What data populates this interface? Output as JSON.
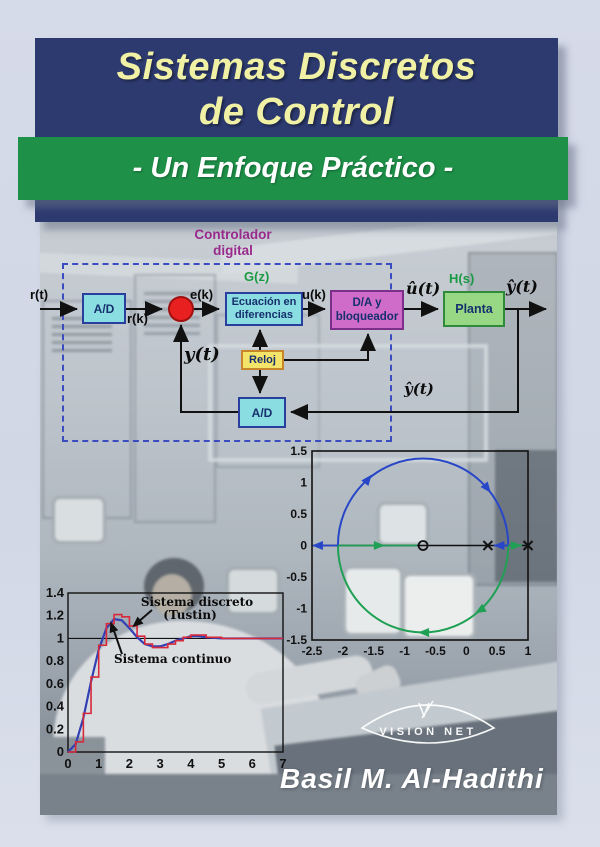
{
  "cover": {
    "title_line1": "Sistemas Discretos",
    "title_line2": "de Control",
    "subtitle": "- Un Enfoque Práctico -",
    "author": "Basil M. Al-Hadithi",
    "publisher": "VISION NET"
  },
  "colors": {
    "background": "#d3d9e7",
    "banner_navy": "#2d3a70",
    "banner_green": "#1e9048",
    "title_yellow": "#f0f1a4",
    "block_cyan": "#8adde0",
    "block_magenta": "#cf6cc9",
    "block_green": "#98d884",
    "block_yellow": "#f5e46a",
    "sum_red": "#e82020",
    "dashed_border_blue": "#3a4cc0",
    "controller_label_purple": "#992a8c",
    "transfer_label_green": "#1a9a44",
    "locus_blue": "#2847c8",
    "locus_green": "#1fa055",
    "curve_blue": "#3340b4",
    "curve_red": "#d8293a"
  },
  "diagram": {
    "controller_label_line1": "Controlador",
    "controller_label_line2": "digital",
    "gz_label": "G(z)",
    "hs_label": "H(s)",
    "blocks": {
      "ad_input": "A/D",
      "difference_eq_line1": "Ecuación en",
      "difference_eq_line2": "diferencias",
      "da_hold_line1": "D/A y",
      "da_hold_line2": "bloqueador",
      "plant": "Planta",
      "clock": "Reloj",
      "ad_feedback": "A/D"
    },
    "signals": {
      "r_t": "r(t)",
      "r_k": "r(k)",
      "e_k": "e(k)",
      "u_k": "u(k)",
      "u_hat_t": "û(t)",
      "y_hat_t_top": "ŷ(t)",
      "y_t": "y(t)",
      "y_hat_t_bottom": "ŷ(t)"
    }
  },
  "chart_data": [
    {
      "type": "scatter",
      "name": "root-locus-z-plane",
      "xlim": [
        -2.5,
        1
      ],
      "ylim": [
        -1.5,
        1.5
      ],
      "x_ticks": [
        -2.5,
        -2,
        -1.5,
        -1,
        -0.5,
        0,
        0.5,
        1
      ],
      "y_ticks": [
        1.5,
        1,
        0.5,
        0,
        -0.5,
        -1,
        -1.5
      ],
      "zeros": [
        {
          "x": -0.7,
          "y": 0
        }
      ],
      "poles": [
        {
          "x": 0.35,
          "y": 0
        },
        {
          "x": 1.0,
          "y": 0
        }
      ],
      "locus_circle": {
        "cx": -0.7,
        "cy": 0,
        "r": 1.38
      },
      "grid": false,
      "legend": "none"
    },
    {
      "type": "line",
      "name": "step-response-comparison",
      "xlim": [
        0,
        7
      ],
      "ylim": [
        0,
        1.4
      ],
      "x_ticks": [
        0,
        1,
        2,
        3,
        4,
        5,
        6,
        7
      ],
      "y_ticks": [
        0,
        0.2,
        0.4,
        0.6,
        0.8,
        1,
        1.2,
        1.4
      ],
      "reference_y": 1,
      "annotations": [
        {
          "line1": "Sistema discreto",
          "line2": "(Tustin)"
        },
        {
          "line1": "Sistema continuo"
        }
      ],
      "series": [
        {
          "name": "Sistema continuo",
          "style": "smooth",
          "color": "#3340b4",
          "x": [
            0,
            0.25,
            0.5,
            0.75,
            1,
            1.25,
            1.5,
            1.75,
            2,
            2.25,
            2.5,
            2.75,
            3,
            3.25,
            3.5,
            3.75,
            4,
            4.25,
            4.5,
            5,
            5.5,
            6,
            6.5,
            7
          ],
          "y": [
            0,
            0.07,
            0.3,
            0.62,
            0.9,
            1.09,
            1.17,
            1.16,
            1.09,
            1.01,
            0.95,
            0.93,
            0.93,
            0.95,
            0.98,
            1.0,
            1.02,
            1.02,
            1.01,
            1.0,
            1.0,
            1.0,
            1.0,
            1.0
          ]
        },
        {
          "name": "Sistema discreto (Tustin)",
          "style": "staircase",
          "color": "#d8293a",
          "x": [
            0,
            0.25,
            0.5,
            0.75,
            1,
            1.25,
            1.5,
            1.75,
            2,
            2.25,
            2.5,
            2.75,
            3,
            3.25,
            3.5,
            3.75,
            4,
            4.25,
            4.5,
            5,
            5.5,
            6,
            6.5,
            7
          ],
          "y": [
            0,
            0.09,
            0.34,
            0.66,
            0.94,
            1.13,
            1.21,
            1.19,
            1.11,
            1.02,
            0.95,
            0.92,
            0.92,
            0.95,
            0.98,
            1.01,
            1.03,
            1.03,
            1.01,
            1.0,
            1.0,
            1.0,
            1.0,
            1.0
          ]
        }
      ]
    }
  ]
}
